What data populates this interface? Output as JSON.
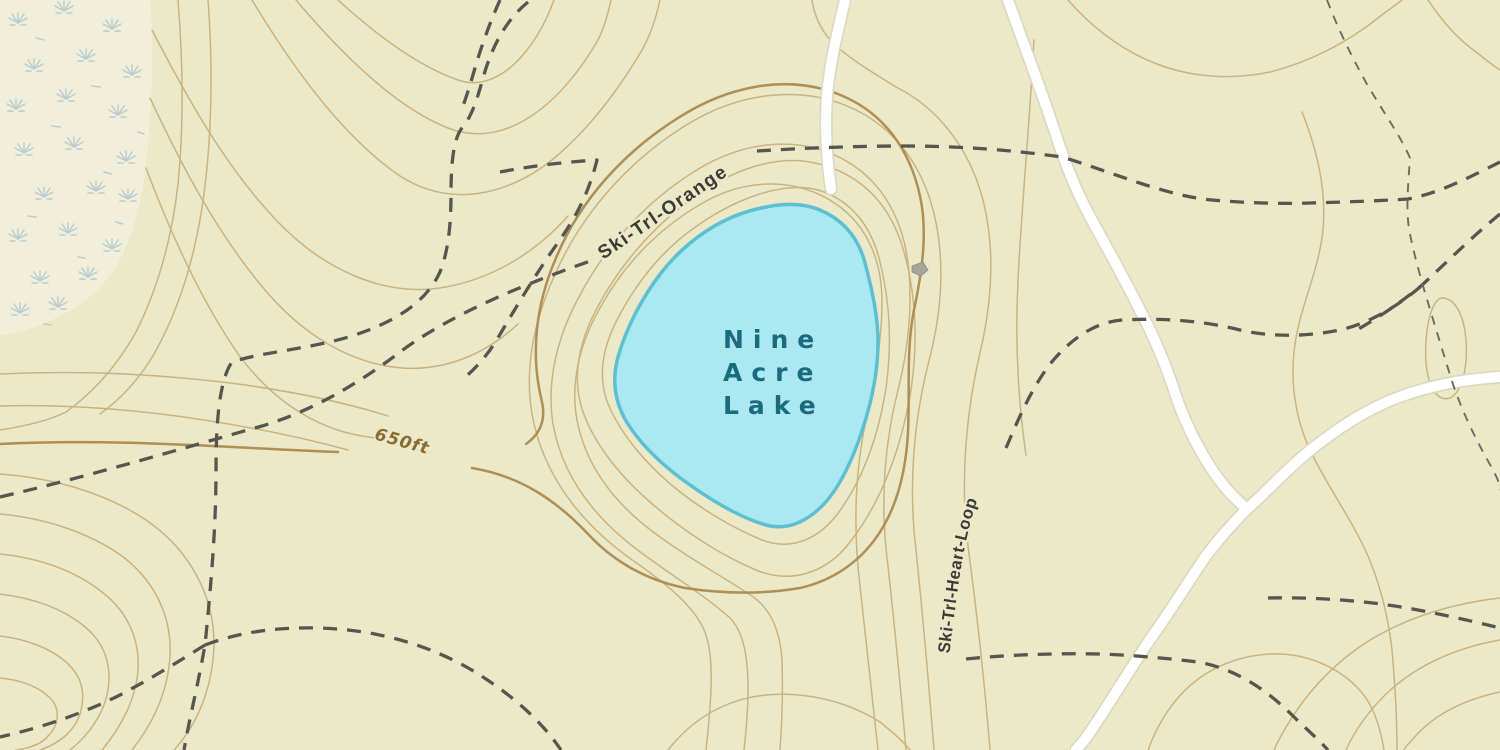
{
  "map": {
    "labels": {
      "lake_name_line1": "Nine",
      "lake_name_line2": "Acre",
      "lake_name_line3": "Lake",
      "trail_orange": "Ski-Trl-Orange",
      "trail_heart_loop": "Ski-Trl-Heart-Loop",
      "elevation": "650ft"
    },
    "features": {
      "lake_name": "Nine Acre Lake",
      "elevation_contour": "650ft",
      "trails": [
        "Ski-Trl-Orange",
        "Ski-Trl-Heart-Loop"
      ]
    },
    "colors": {
      "background": "#ece9c8",
      "marsh_background": "#f1efd9",
      "marsh_symbol": "#b9cdd2",
      "contour": "#c4aa74",
      "contour_index": "#aa8a52",
      "lake_fill": "#abe8f2",
      "lake_outline": "#5cc0d2",
      "lake_label": "#1a6b7e",
      "trail": "#56564f",
      "trail_thin": "#6b6b64",
      "trail_label": "#3a3a36",
      "elevation_label": "#8a6b35",
      "road_fill": "#ffffff",
      "road_casing": "#dcd9c3",
      "building": "#a5a59b"
    }
  }
}
